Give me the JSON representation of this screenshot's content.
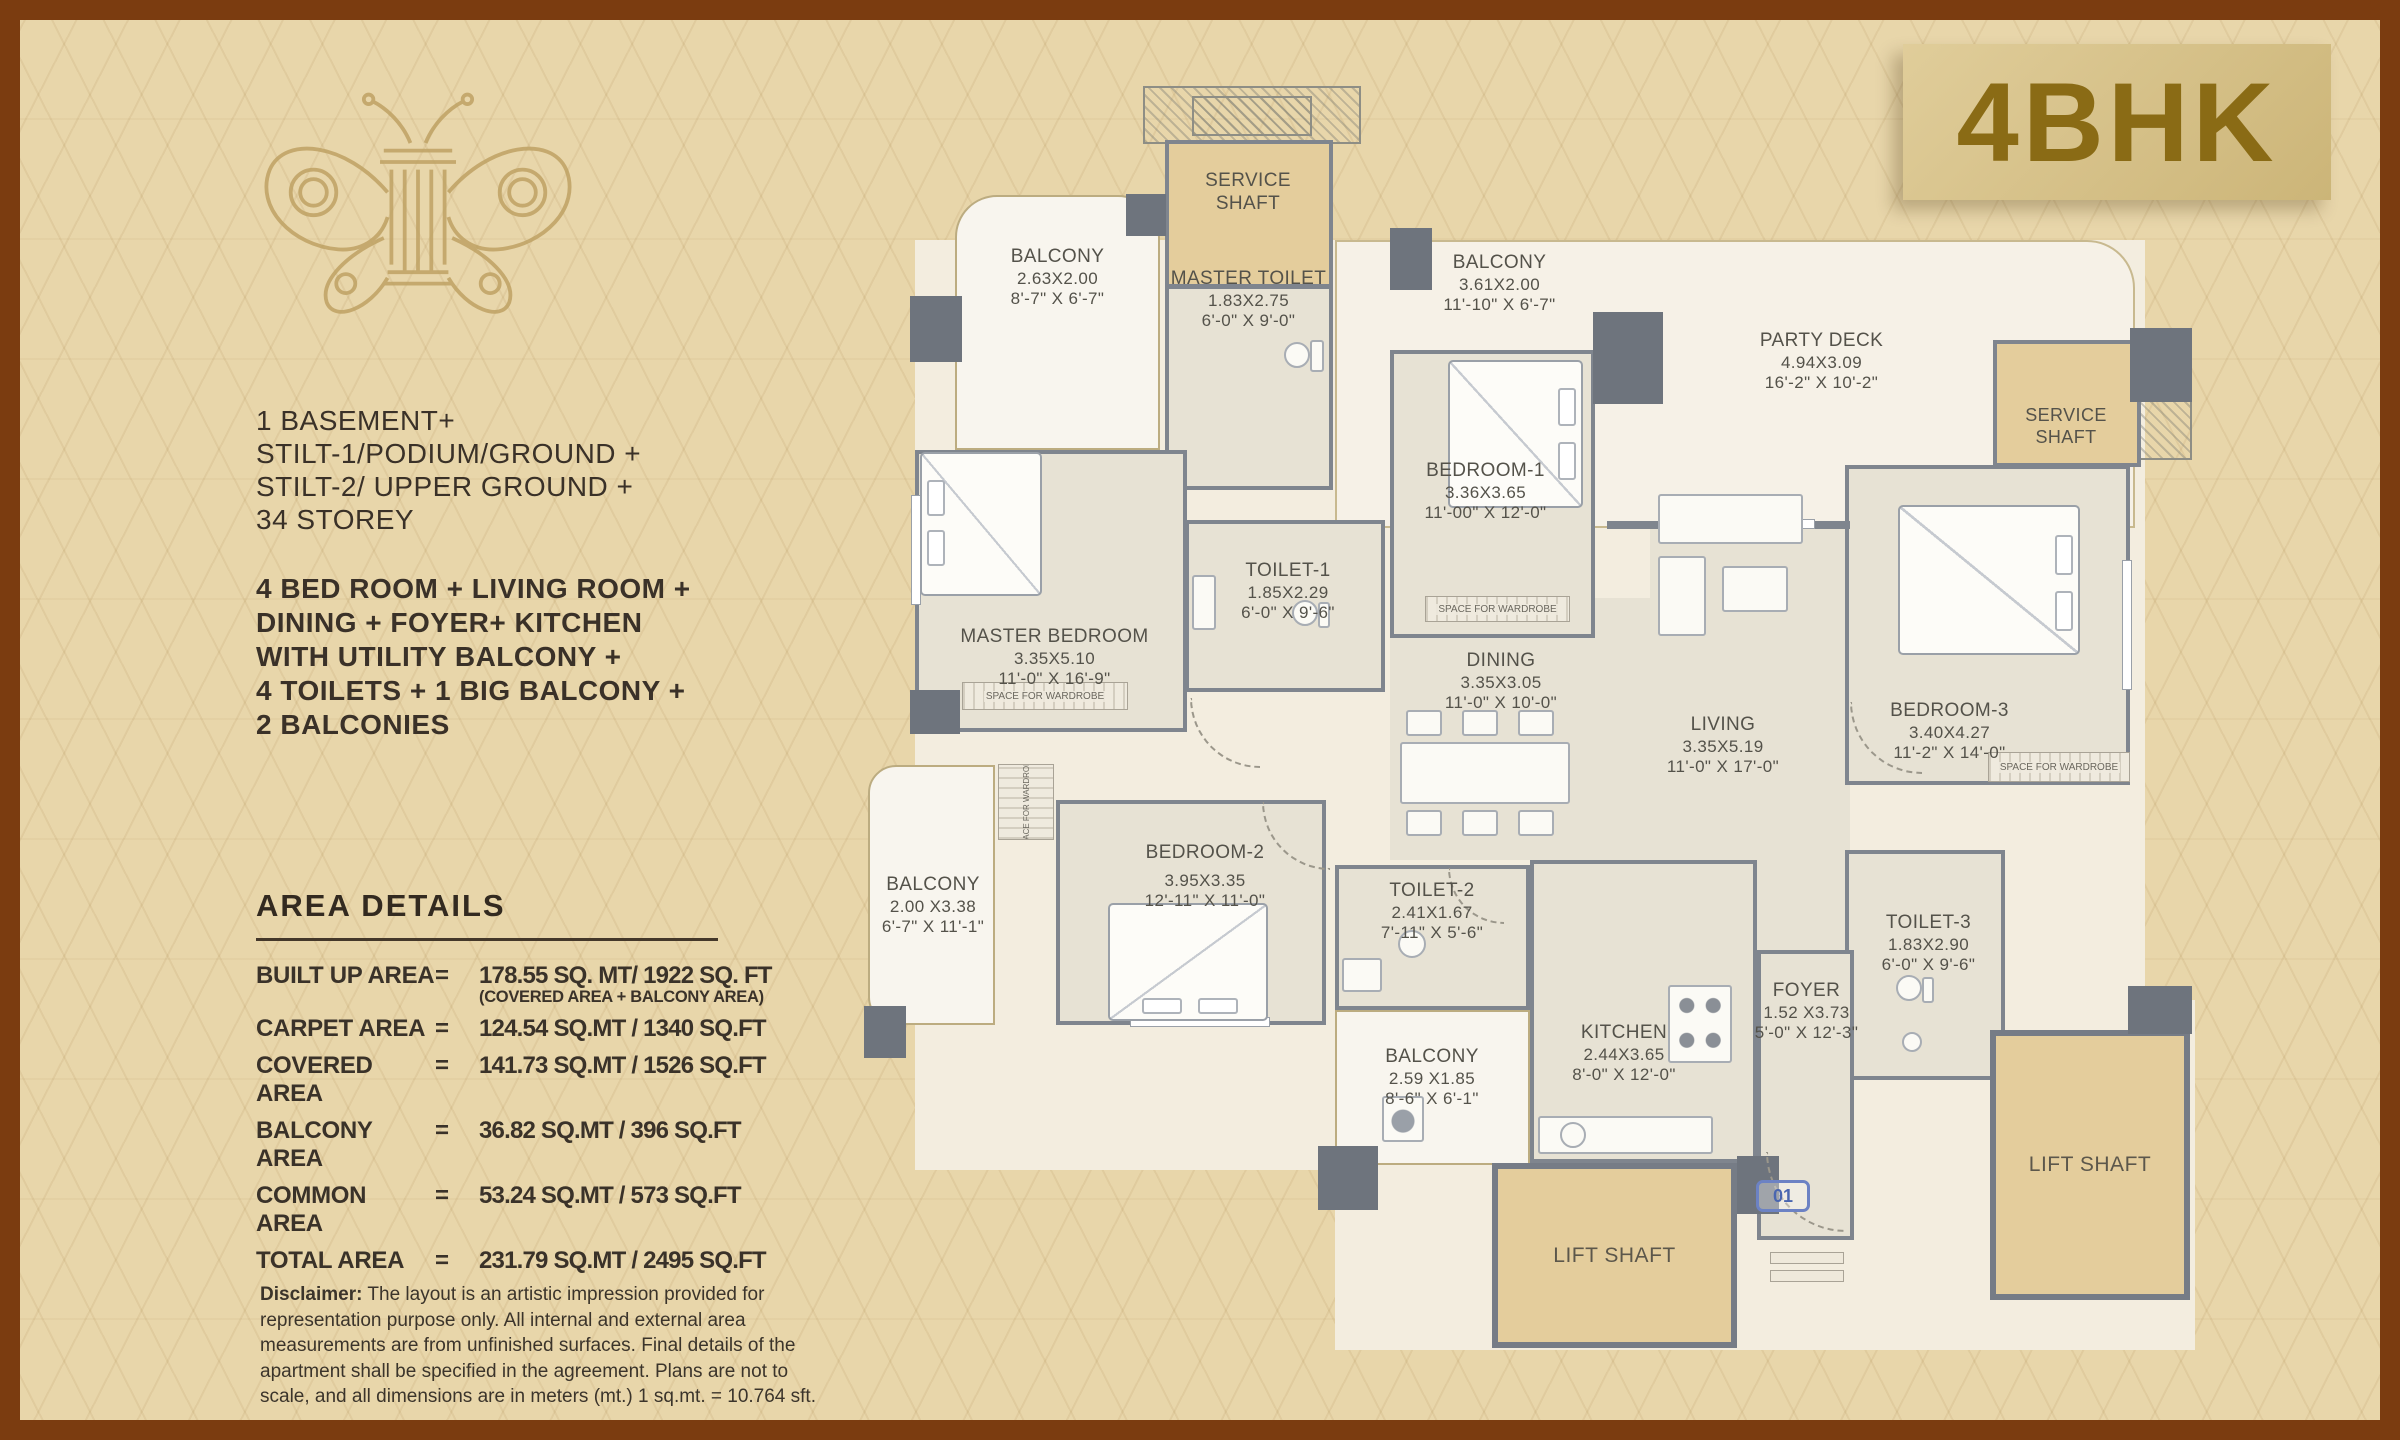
{
  "badge": {
    "label": "4BHK",
    "text_color": "#8a6b15",
    "bg": "#d8c48e"
  },
  "logo": {
    "name": "butterfly-column-logo",
    "color": "#bfa264"
  },
  "building_info": {
    "lines": [
      "1 BASEMENT+",
      "STILT-1/PODIUM/GROUND +",
      "STILT-2/ UPPER GROUND +",
      "34 STOREY"
    ]
  },
  "unit_info": {
    "lines": [
      "4 BED ROOM + LIVING ROOM +",
      "DINING + FOYER+ KITCHEN",
      "WITH UTILITY BALCONY +",
      "4 TOILETS + 1 BIG BALCONY +",
      "2 BALCONIES"
    ]
  },
  "area_details": {
    "title": "AREA DETAILS",
    "rows": [
      {
        "label": "BUILT UP AREA",
        "eq": "=",
        "value": "178.55 SQ. MT/ 1922 SQ. FT",
        "note": "(COVERED AREA + BALCONY AREA)"
      },
      {
        "label": "CARPET AREA",
        "eq": "=",
        "value": "124.54 SQ.MT / 1340 SQ.FT"
      },
      {
        "label": "COVERED AREA",
        "eq": "=",
        "value": "141.73 SQ.MT / 1526 SQ.FT"
      },
      {
        "label": "BALCONY AREA",
        "eq": "=",
        "value": "36.82 SQ.MT / 396 SQ.FT"
      },
      {
        "label": "COMMON AREA",
        "eq": "=",
        "value": "53.24 SQ.MT / 573 SQ.FT"
      },
      {
        "label": "TOTAL AREA",
        "eq": "=",
        "value": "231.79 SQ.MT / 2495 SQ.FT"
      }
    ]
  },
  "disclaimer": {
    "label": "Disclaimer:",
    "text": "The layout is an artistic impression provided for representation purpose only. All internal and external area measurements are from unfinished surfaces. Final details of the apartment shall be specified in the agreement. Plans are not to scale, and all dimensions are in meters (mt.) 1 sq.mt. = 10.764 sft."
  },
  "rooms": {
    "service_shaft_top": {
      "name": "SERVICE SHAFT"
    },
    "balcony_tl": {
      "name": "BALCONY",
      "m": "2.63X2.00",
      "ft": "8'-7\" X 6'-7\""
    },
    "master_toilet": {
      "name": "MASTER TOILET",
      "m": "1.83X2.75",
      "ft": "6'-0\" X 9'-0\""
    },
    "balcony_tr": {
      "name": "BALCONY",
      "m": "3.61X2.00",
      "ft": "11'-10\" X 6'-7\""
    },
    "party_deck": {
      "name": "PARTY DECK",
      "m": "4.94X3.09",
      "ft": "16'-2\" X 10'-2\""
    },
    "service_shaft_right": {
      "name": "SERVICE SHAFT"
    },
    "bedroom_1": {
      "name": "BEDROOM-1",
      "m": "3.36X3.65",
      "ft": "11'-00\" X 12'-0\""
    },
    "toilet_1": {
      "name": "TOILET-1",
      "m": "1.85X2.29",
      "ft": "6'-0\" X 9'-6\""
    },
    "master_bedroom": {
      "name": "MASTER BEDROOM",
      "m": "3.35X5.10",
      "ft": "11'-0\" X 16'-9\""
    },
    "dining": {
      "name": "DINING",
      "m": "3.35X3.05",
      "ft": "11'-0\" X 10'-0\""
    },
    "living": {
      "name": "LIVING",
      "m": "3.35X5.19",
      "ft": "11'-0\" X 17'-0\""
    },
    "bedroom_3": {
      "name": "BEDROOM-3",
      "m": "3.40X4.27",
      "ft": "11'-2\" X 14'-0\""
    },
    "bedroom_2": {
      "name": "BEDROOM-2",
      "m": "3.95X3.35",
      "ft": "12'-11\" X 11'-0\""
    },
    "balcony_left": {
      "name": "BALCONY",
      "m": "2.00 X3.38",
      "ft": "6'-7\" X 11'-1\""
    },
    "toilet_2": {
      "name": "TOILET-2",
      "m": "2.41X1.67",
      "ft": "7'-11\" X 5'-6\""
    },
    "balcony_bottom": {
      "name": "BALCONY",
      "m": "2.59 X1.85",
      "ft": "8'-6\" X 6'-1\""
    },
    "kitchen": {
      "name": "KITCHEN",
      "m": "2.44X3.65",
      "ft": "8'-0\" X 12'-0\""
    },
    "foyer": {
      "name": "FOYER",
      "m": "1.52 X3.73",
      "ft": "5'-0\" X 12'-3\""
    },
    "toilet_3": {
      "name": "TOILET-3",
      "m": "1.83X2.90",
      "ft": "6'-0\" X 9'-6\""
    },
    "lift_shaft_bottom": {
      "name": "LIFT SHAFT"
    },
    "lift_shaft_right": {
      "name": "LIFT SHAFT"
    }
  },
  "plan_labels": {
    "wardrobe": "SPACE FOR WARDROBE",
    "unit_marker": "01"
  },
  "colors": {
    "frame": "#7b3c10",
    "background": "#e8d6aa",
    "wall": "#7f858e",
    "floor": "#e7e2d4",
    "balcony": "#f8f5ee",
    "shaft_tan": "#e4cd9c",
    "marker_blue": "#4a66b0",
    "gold": "#bfa264"
  }
}
